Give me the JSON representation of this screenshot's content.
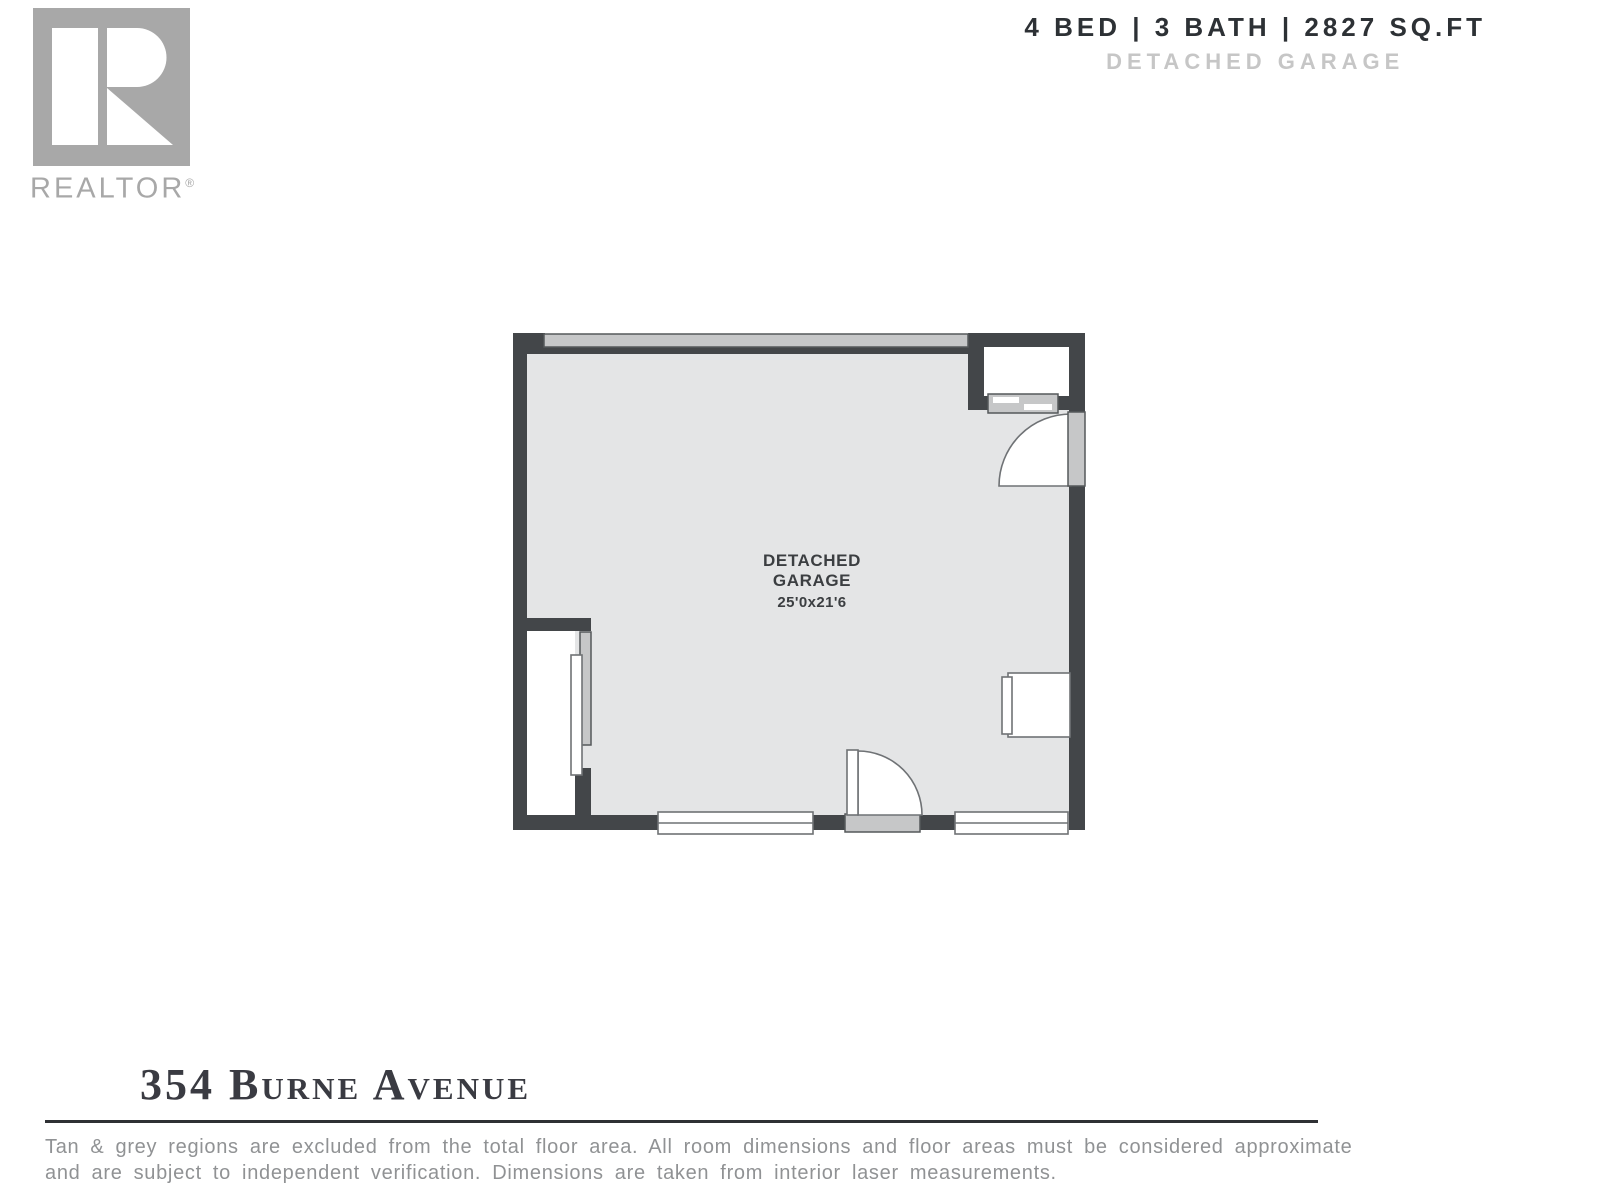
{
  "logo": {
    "letter": "R",
    "brand": "REALTOR",
    "registered": "®"
  },
  "header": {
    "stats": "4 BED | 3 BATH | 2827 SQ.FT",
    "subtitle": "DETACHED GARAGE"
  },
  "plan": {
    "room": {
      "line1": "DETACHED",
      "line2": "GARAGE",
      "dimensions": "25'0x21'6"
    }
  },
  "footer": {
    "address": "354 Burne Avenue",
    "disclaimer_line1": "Tan & grey regions are excluded from the total floor area. All room dimensions and floor areas must be considered approximate",
    "disclaimer_line2": "and are subject to independent verification. Dimensions are taken from interior laser measurements."
  },
  "colors": {
    "wall": "#434649",
    "floor": "#e4e5e6",
    "fixture": "#c6c7c8",
    "fixture_stroke": "#55585a",
    "outline": "#6f7275",
    "header_text": "#2d3135",
    "muted": "#c6c6c6",
    "logo_grey": "#a8a8a8",
    "address_text": "#3a3b42",
    "disclaimer_text": "#909294",
    "rule": "#2f3134"
  }
}
